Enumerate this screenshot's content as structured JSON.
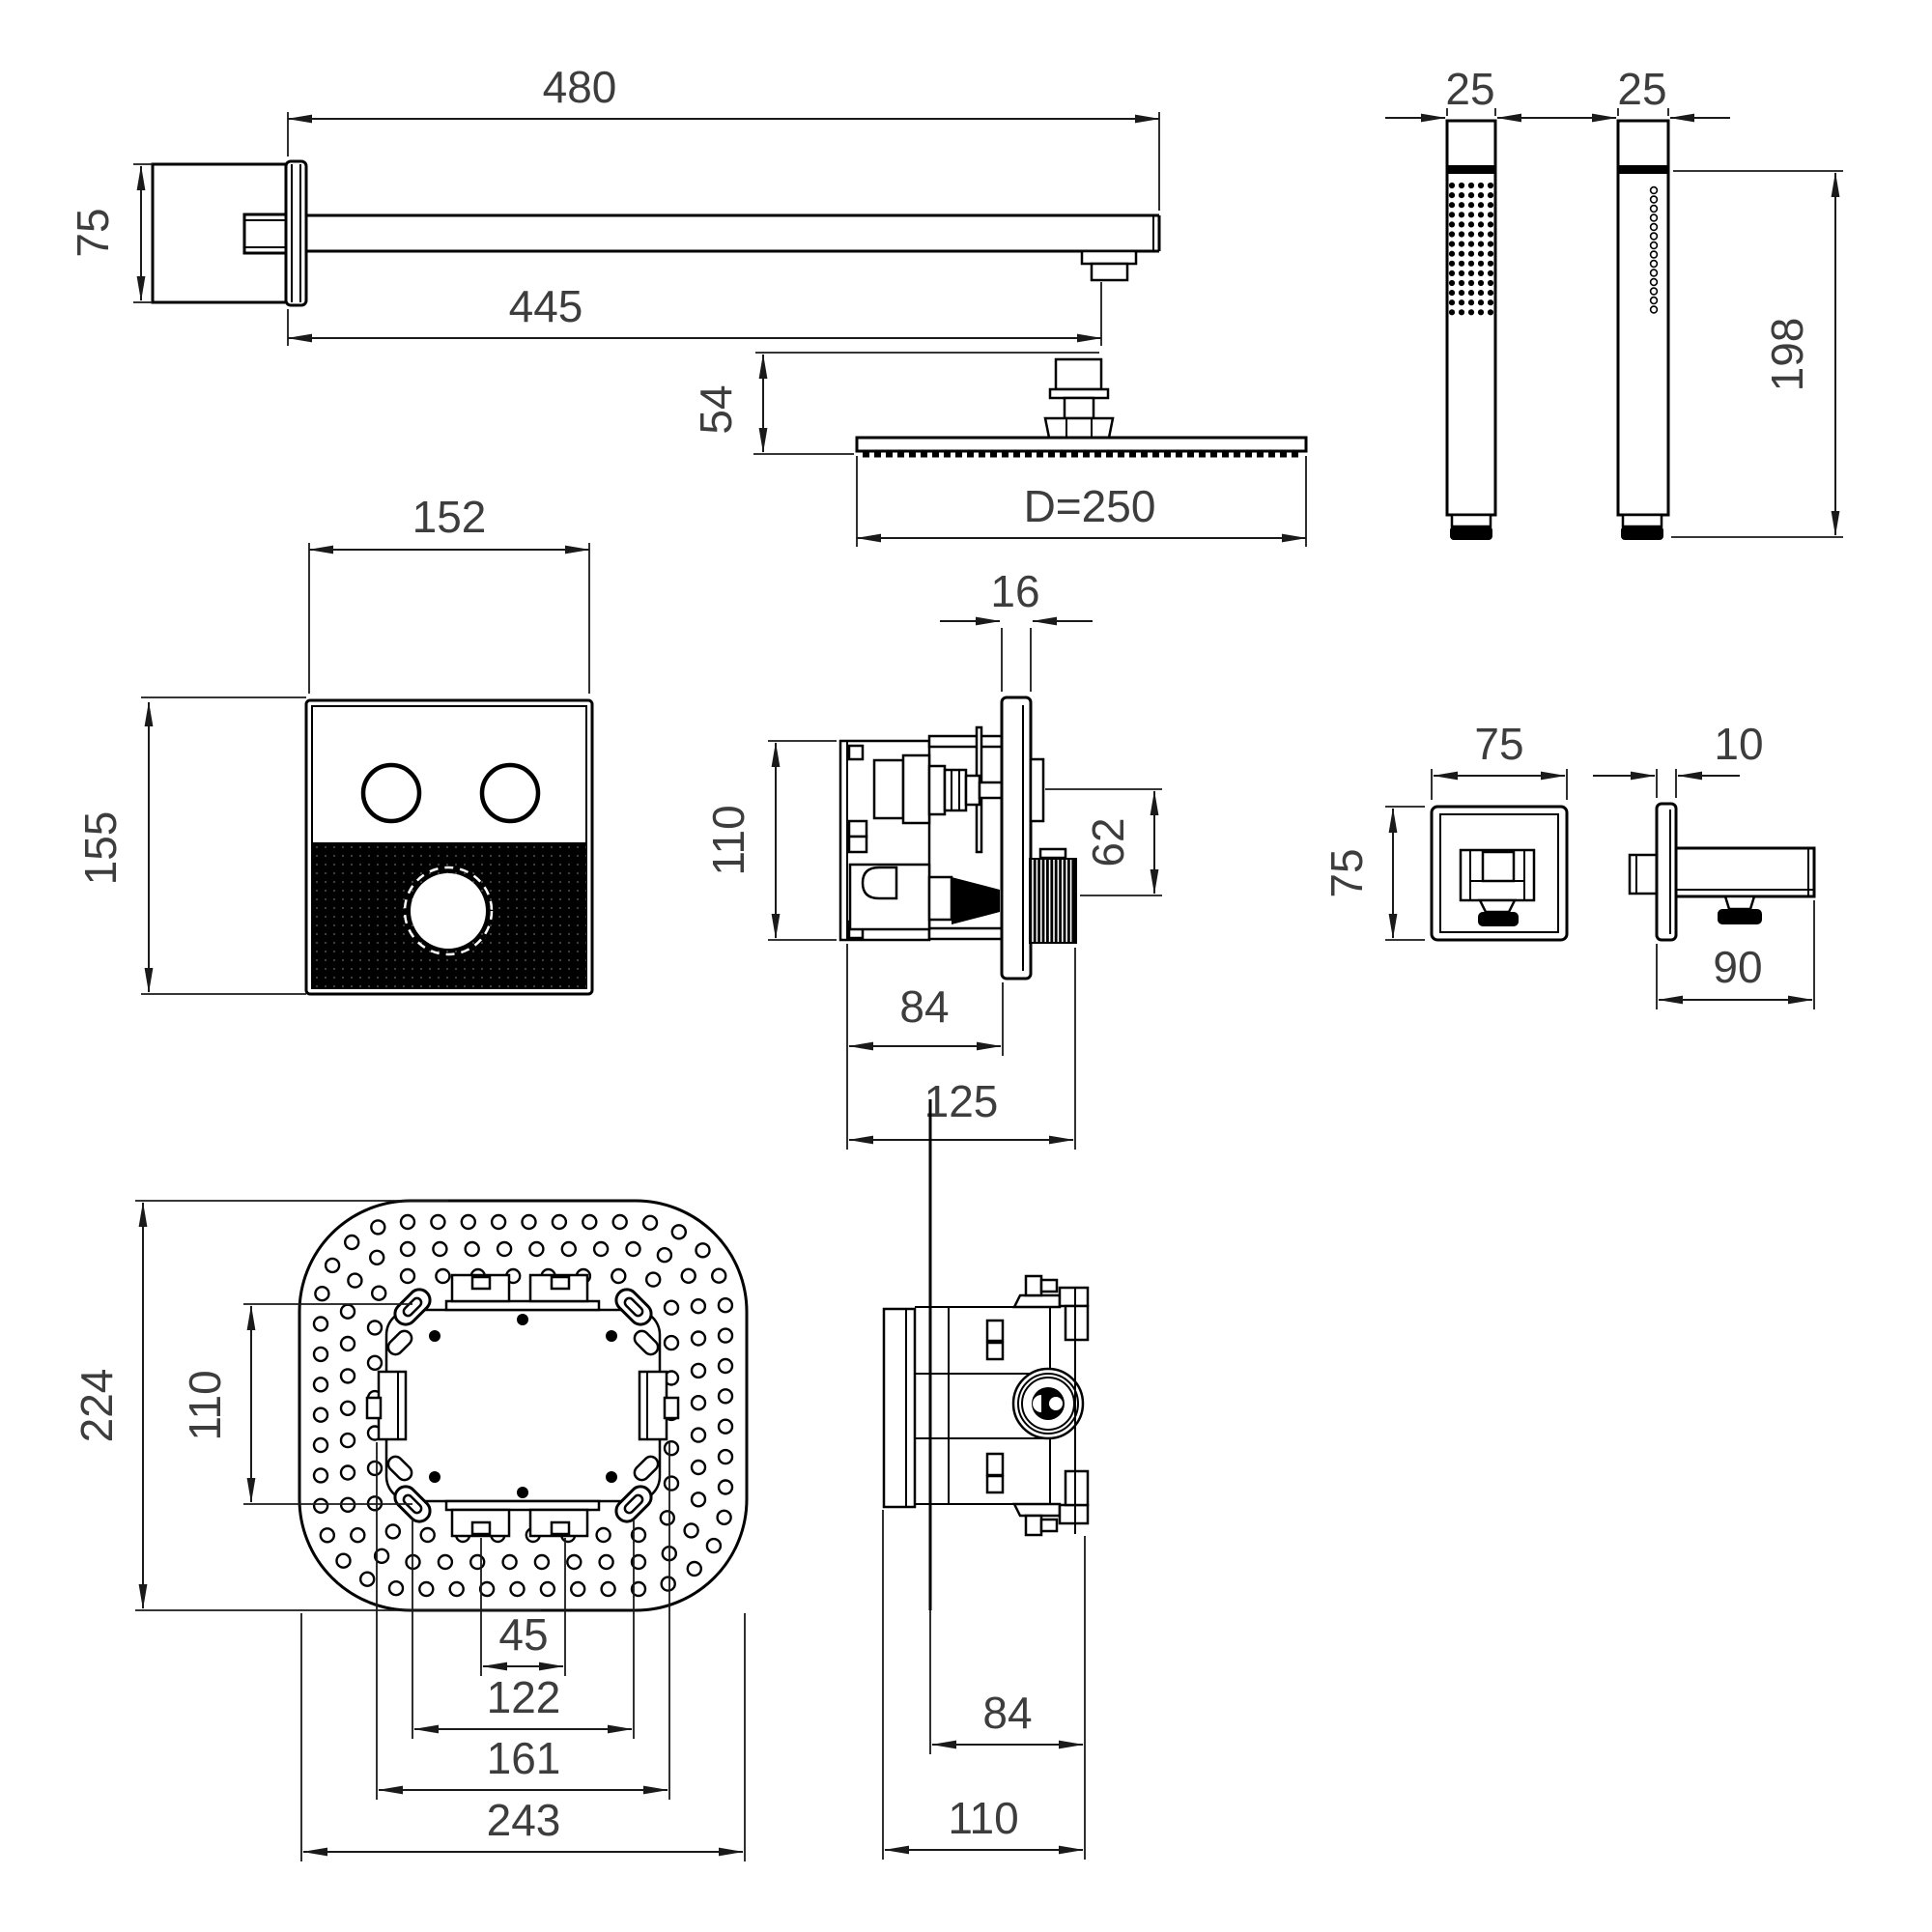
{
  "drawing": {
    "type": "technical-dimension-drawing",
    "subject": "concealed thermostatic shower set installation dimensions",
    "units": "mm",
    "line_color": "#000000",
    "text_color": "#3d3d3d",
    "background": "#ffffff",
    "views": {
      "shower_arm": {
        "name": "wall shower arm side view",
        "length_top": "480",
        "length_to_outlet": "445",
        "flange_height": "75"
      },
      "head_side": {
        "name": "overhead shower side view",
        "connector_height": "54",
        "diameter": "D=250"
      },
      "hand_shower": {
        "name": "hand shower front and side views",
        "width_front": "25",
        "width_side": "25",
        "length": "198"
      },
      "control_panel": {
        "name": "thermostat control panel front view",
        "width": "152",
        "height": "155"
      },
      "valve_side": {
        "name": "concealed valve side view",
        "plate_thickness": "16",
        "body_height": "110",
        "knob_offset": "62",
        "depth_box": "84",
        "depth_total": "125"
      },
      "wall_elbow": {
        "name": "wall outlet elbow front and side views",
        "width": "75",
        "height": "75",
        "plate_thickness": "10",
        "arm_length": "90"
      },
      "head_back": {
        "name": "overhead shower back view with mounting bracket",
        "height": "224",
        "mount_slot_spacing_v": "110",
        "inlet_spacing": "45",
        "slot_spacing_h": "122",
        "bracket_width": "161",
        "width": "243"
      },
      "valve_box": {
        "name": "rough-in valve box side view",
        "depth_box": "84",
        "depth_total": "110"
      }
    }
  }
}
